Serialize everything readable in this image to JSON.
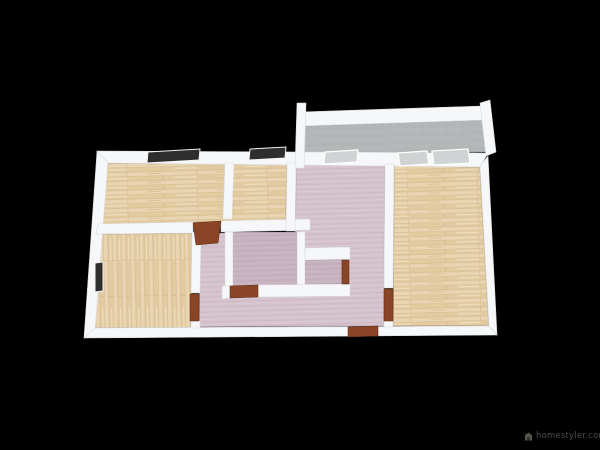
{
  "canvas": {
    "width": 600,
    "height": 450,
    "background": "#000000"
  },
  "watermark": {
    "text": "homestyler.com",
    "icon": "homestyler-logo-icon",
    "color": "#4c4c48"
  },
  "palette": {
    "wall": "#f6f7f8",
    "wall_edge": "#d9dbdd",
    "wood_base": "#e8d3ae",
    "wood_grain": "#c9a87c",
    "wood_highlight": "#f4e7cb",
    "pink_base": "#d5c3ce",
    "pink_stripe": "#c8b3c1",
    "pink_dark_base": "#c8b3c0",
    "pink_dark_stripe": "#bba5b3",
    "balcony_gray": "#b4b7b8",
    "balcony_speck": "#a7aaab",
    "window_dark": "#2e2e2f",
    "window_light": "#cfd3d4",
    "door_wood": "#8a4526"
  },
  "floorplan": {
    "floors": [
      {
        "name": "room-top-left-floor",
        "type": "wood",
        "points": [
          [
            108,
            163
          ],
          [
            287,
            164
          ],
          [
            286,
            220
          ],
          [
            99,
            225
          ]
        ]
      },
      {
        "name": "room-bottom-left-floor",
        "type": "wood_vertical",
        "points": [
          [
            97,
            234
          ],
          [
            192,
            233
          ],
          [
            191,
            328
          ],
          [
            94,
            328
          ]
        ]
      },
      {
        "name": "room-right-floor",
        "type": "wood",
        "points": [
          [
            394,
            165
          ],
          [
            480,
            167
          ],
          [
            489,
            326
          ],
          [
            393,
            326
          ]
        ]
      },
      {
        "name": "hallway-floor",
        "type": "pink",
        "points": [
          [
            296,
            164
          ],
          [
            385,
            164
          ],
          [
            384,
            326
          ],
          [
            199,
            327
          ],
          [
            200,
            233
          ],
          [
            295,
            233
          ]
        ]
      },
      {
        "name": "inner-room-floor",
        "type": "pink_dark",
        "points": [
          [
            233,
            232
          ],
          [
            297,
            232
          ],
          [
            297,
            286
          ],
          [
            233,
            287
          ]
        ]
      },
      {
        "name": "alcove-floor",
        "type": "pink_dark",
        "points": [
          [
            305,
            260
          ],
          [
            342,
            259
          ],
          [
            342,
            284
          ],
          [
            305,
            285
          ]
        ]
      },
      {
        "name": "balcony-floor",
        "type": "gray",
        "points": [
          [
            302,
            126
          ],
          [
            483,
            120
          ],
          [
            486,
            152
          ],
          [
            303,
            154
          ]
        ]
      }
    ],
    "walls": [
      {
        "name": "outer-wall-left",
        "points": [
          [
            97,
            151
          ],
          [
            108,
            161
          ],
          [
            95,
            330
          ],
          [
            84,
            338
          ]
        ]
      },
      {
        "name": "outer-wall-bottom",
        "points": [
          [
            84,
            338
          ],
          [
            95,
            328
          ],
          [
            489,
            326
          ],
          [
            497,
            335
          ]
        ]
      },
      {
        "name": "outer-wall-right",
        "points": [
          [
            497,
            335
          ],
          [
            489,
            326
          ],
          [
            480,
            166
          ],
          [
            488,
            156
          ]
        ]
      },
      {
        "name": "top-wall",
        "points": [
          [
            97,
            151
          ],
          [
            488,
            153
          ],
          [
            480,
            167
          ],
          [
            108,
            163
          ]
        ]
      },
      {
        "name": "balcony-back-wall",
        "points": [
          [
            300,
            112
          ],
          [
            482,
            106
          ],
          [
            484,
            120
          ],
          [
            302,
            126
          ]
        ]
      },
      {
        "name": "balcony-left-post",
        "points": [
          [
            297,
            103
          ],
          [
            306,
            103
          ],
          [
            304,
            168
          ],
          [
            295,
            168
          ]
        ]
      },
      {
        "name": "balcony-right-wall",
        "points": [
          [
            480,
            103
          ],
          [
            490,
            100
          ],
          [
            496,
            152
          ],
          [
            486,
            156
          ]
        ]
      },
      {
        "name": "mid-wall-west",
        "points": [
          [
            98,
            224
          ],
          [
            193,
            222
          ],
          [
            193,
            233
          ],
          [
            96,
            234
          ]
        ]
      },
      {
        "name": "mid-wall-east",
        "points": [
          [
            221,
            221
          ],
          [
            310,
            219
          ],
          [
            310,
            230
          ],
          [
            221,
            232
          ]
        ]
      },
      {
        "name": "top-rooms-divider-wall",
        "points": [
          [
            225,
            163
          ],
          [
            234,
            163
          ],
          [
            232,
            219
          ],
          [
            223,
            219
          ]
        ]
      },
      {
        "name": "corridor-west-wall",
        "points": [
          [
            287,
            163
          ],
          [
            296,
            163
          ],
          [
            295,
            231
          ],
          [
            286,
            231
          ]
        ]
      },
      {
        "name": "right-room-west-wall-upper",
        "points": [
          [
            385,
            164
          ],
          [
            394,
            164
          ],
          [
            393,
            288
          ],
          [
            384,
            288
          ]
        ]
      },
      {
        "name": "right-room-west-wall-lower",
        "points": [
          [
            384,
            321
          ],
          [
            393,
            321
          ],
          [
            393,
            327
          ],
          [
            384,
            327
          ]
        ]
      },
      {
        "name": "left-room-east-wall-upper",
        "points": [
          [
            192,
            232
          ],
          [
            201,
            232
          ],
          [
            200,
            293
          ],
          [
            191,
            293
          ]
        ]
      },
      {
        "name": "left-room-east-wall-lower",
        "points": [
          [
            191,
            321
          ],
          [
            200,
            321
          ],
          [
            200,
            328
          ],
          [
            191,
            328
          ]
        ]
      },
      {
        "name": "inner-room-west-wall",
        "points": [
          [
            225,
            232
          ],
          [
            233,
            232
          ],
          [
            233,
            288
          ],
          [
            225,
            288
          ]
        ]
      },
      {
        "name": "inner-room-east-wall",
        "points": [
          [
            297,
            232
          ],
          [
            305,
            232
          ],
          [
            305,
            288
          ],
          [
            297,
            288
          ]
        ]
      },
      {
        "name": "inner-room-south-wall-west",
        "points": [
          [
            222,
            286
          ],
          [
            230,
            286
          ],
          [
            230,
            298
          ],
          [
            222,
            299
          ]
        ]
      },
      {
        "name": "inner-room-south-wall-east",
        "points": [
          [
            258,
            285
          ],
          [
            350,
            284
          ],
          [
            350,
            296
          ],
          [
            258,
            297
          ]
        ]
      },
      {
        "name": "alcove-north-wall",
        "points": [
          [
            305,
            248
          ],
          [
            350,
            247
          ],
          [
            350,
            259
          ],
          [
            305,
            260
          ]
        ]
      }
    ],
    "windows": [
      {
        "name": "window-top-left-1",
        "type": "dark",
        "points": [
          [
            148,
            152
          ],
          [
            200,
            149
          ],
          [
            199,
            160
          ],
          [
            147,
            163
          ]
        ]
      },
      {
        "name": "window-top-left-2",
        "type": "dark",
        "points": [
          [
            250,
            149
          ],
          [
            286,
            147
          ],
          [
            285,
            158
          ],
          [
            249,
            160
          ]
        ]
      },
      {
        "name": "window-corridor",
        "type": "light",
        "points": [
          [
            325,
            152
          ],
          [
            358,
            150
          ],
          [
            357,
            162
          ],
          [
            324,
            164
          ]
        ]
      },
      {
        "name": "window-right-1",
        "type": "light",
        "points": [
          [
            398,
            153
          ],
          [
            427,
            151
          ],
          [
            429,
            164
          ],
          [
            400,
            166
          ]
        ]
      },
      {
        "name": "window-right-2",
        "type": "light",
        "points": [
          [
            432,
            151
          ],
          [
            468,
            149
          ],
          [
            470,
            163
          ],
          [
            434,
            165
          ]
        ]
      },
      {
        "name": "window-left-wall",
        "type": "dark",
        "points": [
          [
            95,
            263
          ],
          [
            103,
            262
          ],
          [
            103,
            291
          ],
          [
            95,
            292
          ]
        ]
      }
    ],
    "doors": [
      {
        "name": "door-hall-north",
        "points": [
          [
            193,
            223
          ],
          [
            221,
            221
          ],
          [
            218,
            243
          ],
          [
            196,
            245
          ]
        ]
      },
      {
        "name": "door-inner-room",
        "points": [
          [
            230,
            286
          ],
          [
            258,
            285
          ],
          [
            258,
            297
          ],
          [
            230,
            298
          ]
        ]
      },
      {
        "name": "door-bottom-left-room",
        "points": [
          [
            190,
            294
          ],
          [
            199,
            294
          ],
          [
            199,
            321
          ],
          [
            190,
            321
          ]
        ]
      },
      {
        "name": "door-right-room",
        "points": [
          [
            384,
            289
          ],
          [
            393,
            289
          ],
          [
            393,
            321
          ],
          [
            384,
            321
          ]
        ]
      },
      {
        "name": "door-entrance",
        "points": [
          [
            348,
            327
          ],
          [
            378,
            326
          ],
          [
            378,
            336
          ],
          [
            348,
            337
          ]
        ]
      },
      {
        "name": "door-alcove",
        "points": [
          [
            342,
            260
          ],
          [
            349,
            260
          ],
          [
            349,
            284
          ],
          [
            342,
            284
          ]
        ]
      }
    ]
  }
}
